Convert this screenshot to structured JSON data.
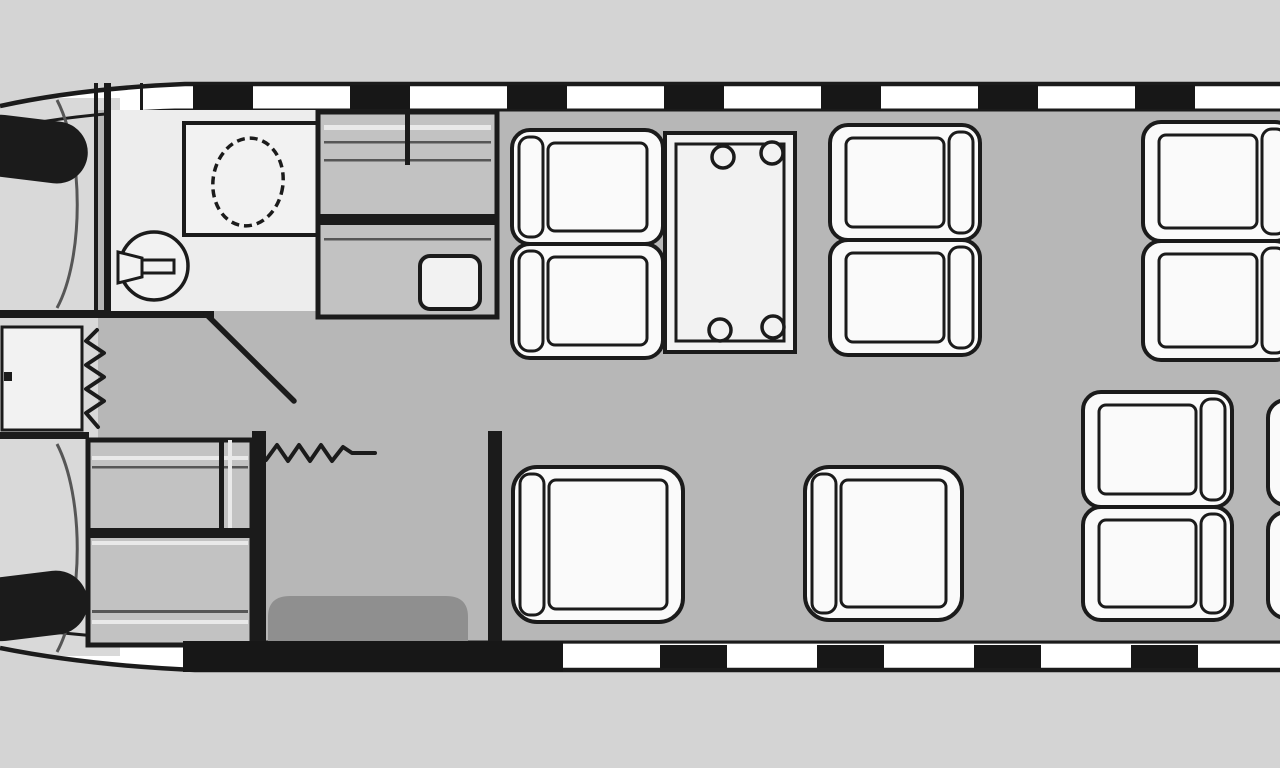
{
  "diagram": {
    "type": "aircraft-cabin-floorplan",
    "orientation": "nose-left",
    "colors": {
      "background": "#d4d4d4",
      "ink": "#1b1b1b",
      "hull_band": "#ffffff",
      "cabin_floor": "#b7b7b7",
      "cockpit_floor": "#d9d9d9",
      "lavatory_floor": "#ededed",
      "cabinet_fill": "#c2c2c2",
      "fixture_fill": "#f2f2f2",
      "seat_fill": "#fafafa",
      "mat_fill": "#8f8f8f",
      "window_fill": "#171717",
      "panel_line": "#565656",
      "shelf_light": "#e9e9e9"
    },
    "fuselage": {
      "windows_top": {
        "count": 7,
        "start_x": 193,
        "spacing": 157,
        "width": 60,
        "y": 85,
        "height": 24
      },
      "windows_bottom": {
        "count": 4,
        "start_x": 660,
        "spacing": 157,
        "width": 67,
        "y": 645,
        "height": 23
      },
      "entry_door": {
        "x": 183,
        "y": 641,
        "width": 380,
        "height": 31
      }
    },
    "cabin": {
      "crew_seats": 2,
      "passenger_seats": [
        {
          "id": "A1",
          "kind": "club",
          "x": 512,
          "y": 130,
          "w": 151,
          "h": 114,
          "facing": "right"
        },
        {
          "id": "A2",
          "kind": "club",
          "x": 512,
          "y": 244,
          "w": 151,
          "h": 114,
          "facing": "right"
        },
        {
          "id": "B1",
          "kind": "club",
          "x": 830,
          "y": 125,
          "w": 150,
          "h": 115,
          "facing": "left"
        },
        {
          "id": "B2",
          "kind": "club",
          "x": 830,
          "y": 240,
          "w": 150,
          "h": 115,
          "facing": "left"
        },
        {
          "id": "C1",
          "kind": "club",
          "x": 1143,
          "y": 122,
          "w": 150,
          "h": 119,
          "facing": "left"
        },
        {
          "id": "C2",
          "kind": "club",
          "x": 1143,
          "y": 241,
          "w": 150,
          "h": 119,
          "facing": "left"
        },
        {
          "id": "D",
          "kind": "single",
          "x": 513,
          "y": 467,
          "w": 170,
          "h": 155,
          "facing": "right"
        },
        {
          "id": "E",
          "kind": "single",
          "x": 805,
          "y": 467,
          "w": 157,
          "h": 153,
          "facing": "right"
        },
        {
          "id": "F1",
          "kind": "club",
          "x": 1083,
          "y": 392,
          "w": 149,
          "h": 115,
          "facing": "left"
        },
        {
          "id": "F2",
          "kind": "club",
          "x": 1083,
          "y": 507,
          "w": 149,
          "h": 113,
          "facing": "left"
        },
        {
          "id": "G1",
          "kind": "club",
          "x": 1268,
          "y": 400,
          "w": 70,
          "h": 105,
          "facing": "left"
        },
        {
          "id": "G2",
          "kind": "club",
          "x": 1268,
          "y": 512,
          "w": 70,
          "h": 106,
          "facing": "left"
        }
      ],
      "table": {
        "x": 665,
        "y": 133,
        "width": 130,
        "height": 219,
        "inner_inset": 11,
        "cupholder_radius": 11,
        "cupholders": [
          [
            723,
            157
          ],
          [
            772,
            153
          ],
          [
            720,
            330
          ],
          [
            773,
            327
          ]
        ]
      }
    }
  }
}
